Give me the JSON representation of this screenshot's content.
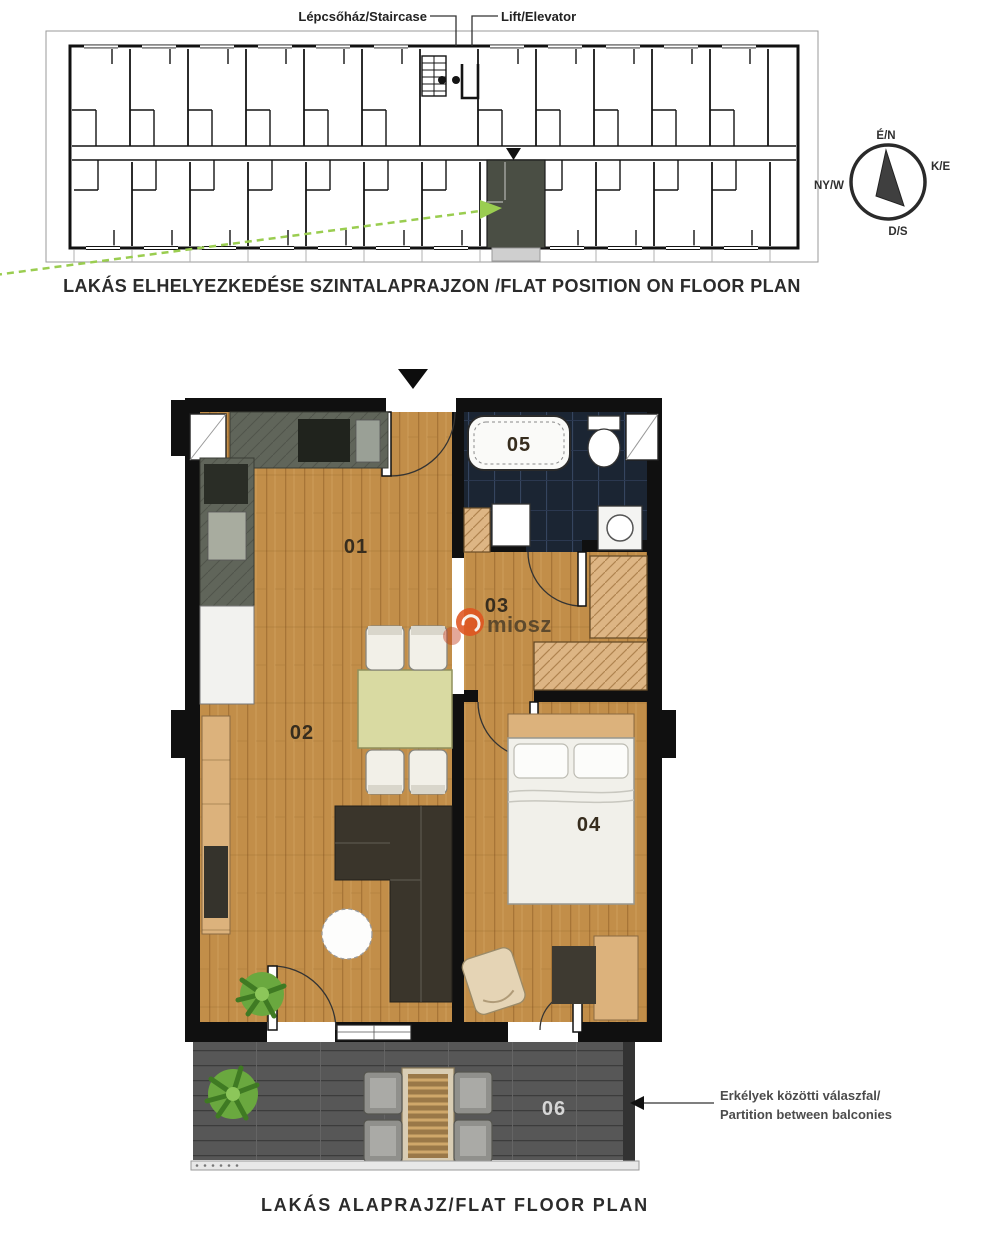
{
  "overview": {
    "staircase_label": "Lépcsőház/Staircase",
    "elevator_label": "Lift/Elevator",
    "caption": "LAKÁS ELHELYEZKEDÉSE SZINTALAPRAJZON /FLAT POSITION ON FLOOR PLAN",
    "compass": {
      "north": "É/N",
      "east": "K/E",
      "south": "D/S",
      "west": "NY/W"
    }
  },
  "flat": {
    "caption": "LAKÁS ALAPRAJZ/FLAT FLOOR PLAN",
    "rooms": [
      {
        "label": "01",
        "name": "kitchen-dining"
      },
      {
        "label": "02",
        "name": "living-room"
      },
      {
        "label": "03",
        "name": "hallway"
      },
      {
        "label": "04",
        "name": "bedroom"
      },
      {
        "label": "05",
        "name": "bathroom"
      },
      {
        "label": "06",
        "name": "balcony"
      }
    ],
    "partition_note": {
      "line1": "Erkélyek közötti válaszfal/",
      "line2": "Partition between balconies"
    }
  },
  "watermark": {
    "text": "miosz"
  },
  "colors": {
    "wall": "#101010",
    "wood_floor": "#c28e49",
    "bathroom_tile": "#1b2533",
    "kitchen_counter": "#60655a",
    "balcony_deck": "#575757",
    "highlight_unit": "#4a4e44",
    "arrow_green": "#9acd50",
    "watermark_orange": "#e05520"
  }
}
